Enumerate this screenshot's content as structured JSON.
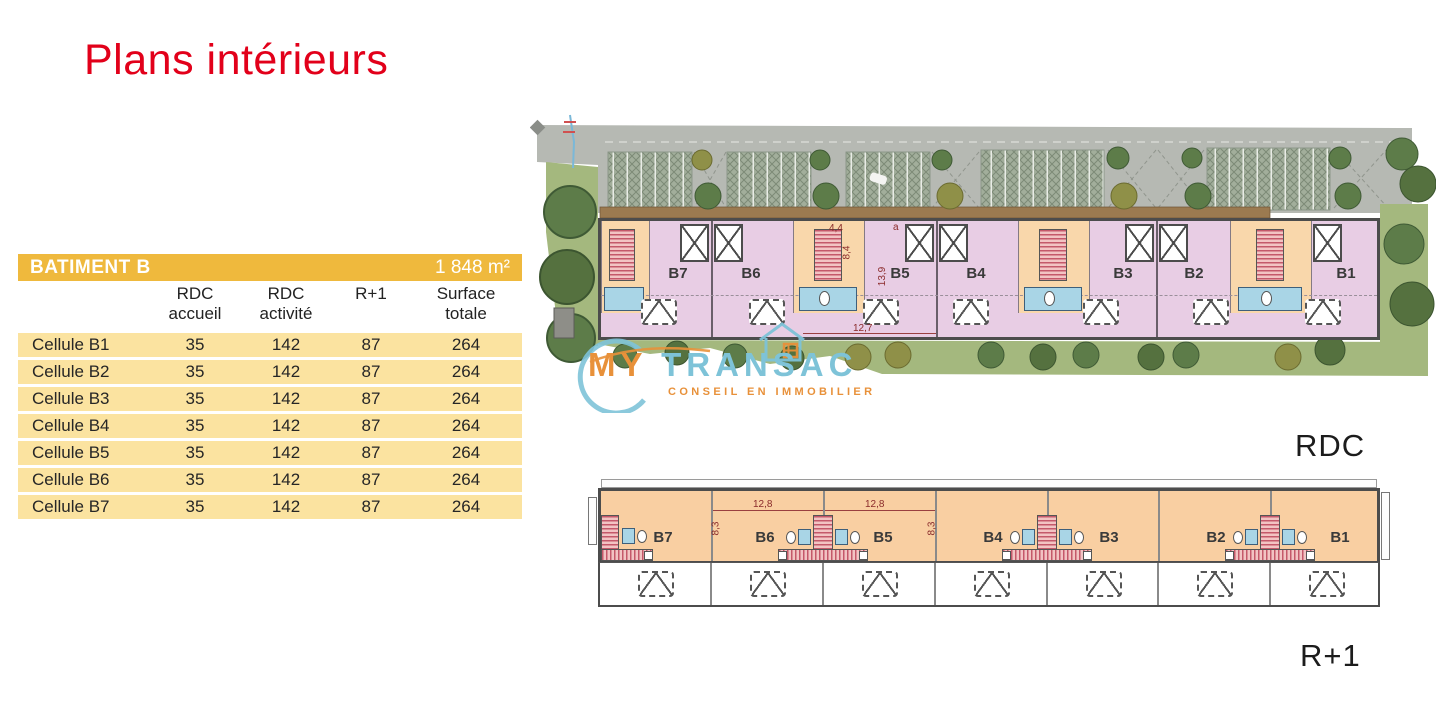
{
  "page": {
    "title": "Plans intérieurs"
  },
  "table": {
    "header": {
      "title": "BATIMENT B",
      "area": "1 848 m²"
    },
    "col_headers": [
      "RDC accueil",
      "RDC activité",
      "R+1",
      "Surface totale"
    ],
    "rows": [
      {
        "label": "Cellule B1",
        "accueil": "35",
        "activite": "142",
        "r1": "87",
        "total": "264"
      },
      {
        "label": "Cellule B2",
        "accueil": "35",
        "activite": "142",
        "r1": "87",
        "total": "264"
      },
      {
        "label": "Cellule B3",
        "accueil": "35",
        "activite": "142",
        "r1": "87",
        "total": "264"
      },
      {
        "label": "Cellule B4",
        "accueil": "35",
        "activite": "142",
        "r1": "87",
        "total": "264"
      },
      {
        "label": "Cellule B5",
        "accueil": "35",
        "activite": "142",
        "r1": "87",
        "total": "264"
      },
      {
        "label": "Cellule B6",
        "accueil": "35",
        "activite": "142",
        "r1": "87",
        "total": "264"
      },
      {
        "label": "Cellule B7",
        "accueil": "35",
        "activite": "142",
        "r1": "87",
        "total": "264"
      }
    ]
  },
  "plans": {
    "rdc": {
      "label": "RDC",
      "cells": [
        "B7",
        "B6",
        "B5",
        "B4",
        "B3",
        "B2",
        "B1"
      ],
      "dims": {
        "hall_w": "4,4",
        "hall_d": "8,4",
        "cell_d": "13,9",
        "cell_w": "12,7",
        "corner": "a"
      }
    },
    "r1": {
      "label": "R+1",
      "cells": [
        "B7",
        "B6",
        "B5",
        "B4",
        "B3",
        "B2",
        "B1"
      ],
      "dims": {
        "w_b6": "12,8",
        "w_b5": "12,8",
        "d_left": "8,3",
        "d_right": "8,3"
      }
    }
  },
  "watermark": {
    "my": "MY",
    "transac": "TRANSAC",
    "tagline": "CONSEIL EN IMMOBILIER"
  },
  "colors": {
    "accent_red": "#e2001a",
    "gold": "#efb93d",
    "row_yellow": "#fbe3a0",
    "plan_pink": "#e8cde4",
    "plan_peach": "#f9d7ab",
    "plan_orange": "#f9cfa2",
    "sanitary_blue": "#a9d5e6",
    "lawn_green": "#a4b87e",
    "road_grey": "#b6b9b3",
    "logo_orange": "#e8913a",
    "logo_blue": "#7ec3d8"
  }
}
